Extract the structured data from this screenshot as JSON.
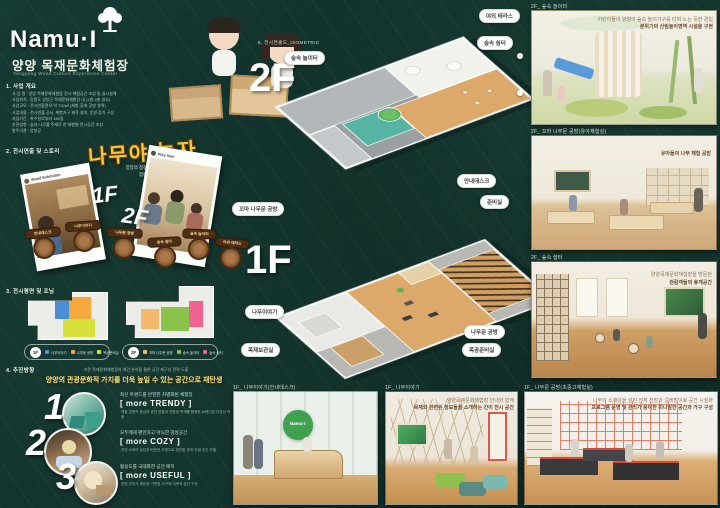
{
  "logo": {
    "name": "Namu·I",
    "title_kr": "양양 목재문화체험장",
    "title_en": "Yangyang Wood Culture Experience Center"
  },
  "colors": {
    "background": "#113029",
    "accent_yellow": "#f7c832",
    "zone_blue": "#4a90d9",
    "zone_orange": "#f5a83c",
    "zone_yellow": "#d8e13c",
    "zone_peach": "#f5b96e",
    "zone_green": "#8bc34a",
    "zone_pink": "#f06292",
    "badge_brown": "#4f2f14"
  },
  "s1": {
    "heading": "1. 사업 개요",
    "lines": [
      "사 업 명 : 양양 목재문화체험장 전시·체험공간 조성 및 실시설계",
      "사업위치 : 강원도 양양군 목재문화체험장 내 (1층·2층 일부)",
      "사업규모 : 전시연출면적 약 700㎡ (체험·휴게·공방 영역)",
      "사업내용 : 전시연출 공사, 체험가구 제작·설치, 운영 집기 구성",
      "사업기간 : 착수일로부터 180일",
      "추진방향 : 숲과 나무를 주제로 한 체험형 전시공간 조성",
      "발주기관 : 양양군"
    ]
  },
  "s2": {
    "heading": "2. 전시연출 및 스토리",
    "main_title": "나무야 놀자",
    "sub1": "양양의 청정한 숲 속에서 자라는 나무와",
    "sub2": "함께 노는 아이들 이야기",
    "card1_handle": "Wood Exhibition",
    "card2_handle": "Play time",
    "floor1": "1F",
    "floor2": "2F",
    "badges_1f": [
      "안내데스크",
      "나무이야기",
      "나무문 공방"
    ],
    "badges_2f": [
      "숲속 쉼터",
      "숲속 놀이터",
      "야외 테라스"
    ]
  },
  "s3": {
    "heading": "3. 전시평면 및 조닝",
    "legend_1f": {
      "floor": "1F",
      "items": [
        {
          "label": "나무이야기",
          "color": "#4a90d9"
        },
        {
          "label": "나무문 공방",
          "color": "#f5a83c"
        },
        {
          "label": "목공준비실",
          "color": "#d8e13c"
        }
      ]
    },
    "legend_2f": {
      "floor": "2F",
      "items": [
        {
          "label": "꼬마 나무문 공방",
          "color": "#f5b96e"
        },
        {
          "label": "숲속 놀이터",
          "color": "#8bc34a"
        },
        {
          "label": "숲속 쉼터",
          "color": "#f06292"
        }
      ]
    }
  },
  "s4": {
    "heading": "4. 추진방향",
    "intro": "기존 목재문화체험장의 여건 분석을 통한 공간 재구성 전략 도출",
    "headline": "양양의 관광문화적 가치를 더욱 높일 수 있는 공간으로 재탄생",
    "items": [
      {
        "num": "1",
        "lead": "최신 트렌드를 반영한 차별화된 체험장",
        "keyword": "[ more TRENDY ]",
        "sub": "체험 콘텐츠 중심의 공간 연출과 친환경 목재를 활용한 트렌디한 디자인 적용"
      },
      {
        "num": "2",
        "lead": "모두에게 편안하고 아늑한 감성공간",
        "keyword": "[ more COZY ]",
        "sub": "자연 소재의 질감과 따뜻한 조명으로 편안한 휴게·관람 공간 연출"
      },
      {
        "num": "3",
        "lead": "활용도를 극대화한 공간 배치",
        "keyword": "[ more USEFUL ]",
        "sub": "운영·관리가 용이한 가변형 가구와 다목적 공간 구성"
      }
    ]
  },
  "center": {
    "label": "5. 전시연출도_ISOMETRIC",
    "floor2": "2F",
    "floor1": "1F",
    "callouts_2f": [
      "야외 테라스",
      "숲속 쉼터",
      "숲속 놀이터"
    ],
    "callouts_1f": [
      "꼬마 나무문 공방",
      "안내데스크",
      "준비실",
      "나무이야기",
      "목재보관실",
      "나무문 공방",
      "목공준비실"
    ]
  },
  "right": {
    "cards": [
      {
        "label": "2F_ 숲속 놀이터",
        "cap1": "어린이들이 양양의 숲속 놀이기구를 타며 노는 듯한 경험",
        "cap2": "분위기의 산림놀이영역 시설을 구현"
      },
      {
        "label": "2F_ 꼬마 나무문 공방(유아체험실)",
        "cap1": "유아들의 나무 체험 공방",
        "cap2": ""
      },
      {
        "label": "2F_ 숲속 쉼터",
        "cap1": "양양목재문화체험장을 방문한",
        "cap2": "관람객들의 휴게공간"
      },
      {
        "label": "1F_ 나무문 공방(초중고체험실)",
        "cap1": "나무의 소재감을 살린 전체 천장과 걸레받이로 공간 시설화",
        "cap2": "프로그램 운영 및 관리가 용이한 미니멀한 공간과 가구 구성"
      }
    ]
  },
  "bottom": {
    "cards": [
      {
        "label": "1F_ 나무이야기(안내데스크)",
        "desk_logo": "Namu·I"
      },
      {
        "label": "1F_ 나무이야기",
        "cap1": "양양목재문화체험장 안내와 함께",
        "cap2": "목재와 관련된 정보들을 소개하는 간이 전시 공간"
      }
    ]
  }
}
